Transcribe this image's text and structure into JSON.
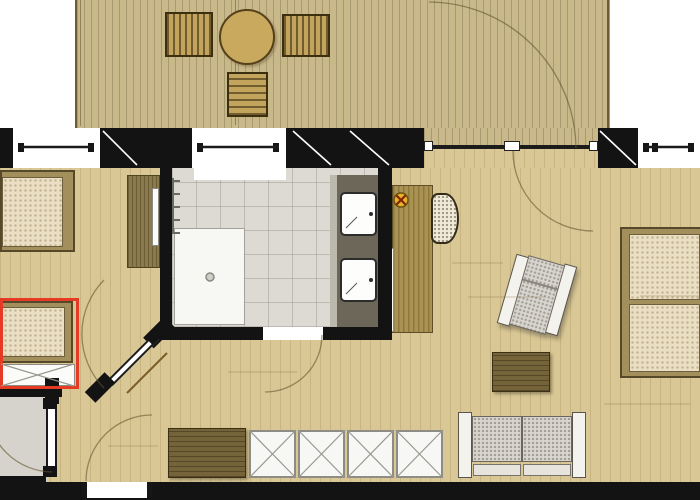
{
  "meta": {
    "title": "apartment-floor-plan",
    "description": "Top-view architectural floor plan of a suite: wooden terrace with loungers and round table at top, bedroom with two single beds (one highlighted red) at left, central bathroom with shower and double vanity, living/sleeping room at right with double bed, armchair, sofa, coffee table, desk and closet row",
    "canvas": {
      "width": 700,
      "height": 500
    },
    "visible_text": []
  },
  "palette": {
    "wall": "#131313",
    "deck_wood": "#c8b88a",
    "interior_wood": "#d9c895",
    "bath_tile": "#dcdad3",
    "vanity_counter": "#6d675a",
    "mattress": "#eadfc4",
    "dark_furniture_wood": "#75633a",
    "highlight_red": "#e63a24",
    "lamp_symbol_yellow": "#e9b22a",
    "upholstery_gray": "#d8d5ce"
  },
  "shapes": [
    {
      "name": "terrace-deck-floor",
      "cls": "deck",
      "x": 75,
      "y": 0,
      "w": 535,
      "h": 128
    },
    {
      "name": "deck-edge-line-left",
      "cls": "dline",
      "x": 80,
      "y": 0,
      "w": 1,
      "h": 126
    },
    {
      "name": "deck-edge-line-mid",
      "cls": "dline",
      "x": 235,
      "y": 0,
      "w": 1,
      "h": 125
    },
    {
      "name": "deck-edge-line-right",
      "cls": "dedge",
      "x": 607,
      "y": 0,
      "w": 2,
      "h": 128
    },
    {
      "name": "deck-lounger-1",
      "cls": "lounger",
      "x": 165,
      "y": 12,
      "w": 48,
      "h": 45
    },
    {
      "name": "deck-lounger-2",
      "cls": "lounger",
      "x": 282,
      "y": 14,
      "w": 48,
      "h": 43
    },
    {
      "name": "deck-round-table",
      "cls": "decktable",
      "x": 219,
      "y": 9,
      "w": 56,
      "h": 56
    },
    {
      "name": "deck-bench",
      "cls": "bench",
      "x": 227,
      "y": 72,
      "w": 41,
      "h": 45
    },
    {
      "name": "main-wood-floor",
      "cls": "floor",
      "x": 0,
      "y": 168,
      "w": 700,
      "h": 314
    },
    {
      "name": "vestibule-floor",
      "cls": "gray",
      "x": 0,
      "y": 395,
      "w": 47,
      "h": 87
    },
    {
      "name": "terrace-door-deck-strip",
      "cls": "decknb",
      "x": 424,
      "y": 128,
      "w": 174,
      "h": 19
    },
    {
      "name": "terrace-door-floor-strip",
      "cls": "floor",
      "x": 424,
      "y": 147,
      "w": 174,
      "h": 21
    },
    {
      "name": "bathroom-tile-floor",
      "cls": "tile",
      "x": 172,
      "y": 168,
      "w": 206,
      "h": 159
    },
    {
      "name": "window-2-sill-recess",
      "cls": "white",
      "x": 194,
      "y": 168,
      "w": 92,
      "h": 12
    },
    {
      "name": "shower-tray",
      "cls": "shower",
      "x": 174,
      "y": 228,
      "w": 71,
      "h": 97
    },
    {
      "name": "towel-radiator",
      "cls": "rad",
      "x": 172,
      "y": 178,
      "w": 8,
      "h": 56
    },
    {
      "name": "vanity-edge-strip",
      "cls": "ltstrip",
      "x": 330,
      "y": 175,
      "w": 7,
      "h": 155
    },
    {
      "name": "vanity-counter",
      "cls": "counter",
      "x": 337,
      "y": 175,
      "w": 41,
      "h": 155
    },
    {
      "name": "sink-1",
      "cls": "sink",
      "x": 340,
      "y": 192,
      "w": 37,
      "h": 44
    },
    {
      "name": "sink-2",
      "cls": "sink",
      "x": 340,
      "y": 258,
      "w": 37,
      "h": 44
    },
    {
      "name": "bed-1-frame",
      "cls": "bedframe",
      "x": 0,
      "y": 170,
      "w": 75,
      "h": 82
    },
    {
      "name": "bed-1-mattress",
      "cls": "matt",
      "x": 2,
      "y": 177,
      "w": 61,
      "h": 70
    },
    {
      "name": "bedroom-wardrobe",
      "cls": "dwv",
      "x": 127,
      "y": 175,
      "w": 33,
      "h": 93
    },
    {
      "name": "wardrobe-door-panel",
      "cls": "panel",
      "x": 152,
      "y": 188,
      "w": 7,
      "h": 58
    },
    {
      "name": "bed-2-frame",
      "cls": "bedframe",
      "x": 0,
      "y": 301,
      "w": 73,
      "h": 62
    },
    {
      "name": "bed-2-mattress",
      "cls": "matt",
      "x": 2,
      "y": 307,
      "w": 63,
      "h": 50
    },
    {
      "name": "bed-2-pullout-area",
      "cls": "panel",
      "x": 0,
      "y": 364,
      "w": 75,
      "h": 22
    },
    {
      "name": "desk",
      "cls": "desk",
      "x": 392,
      "y": 185,
      "w": 41,
      "h": 148
    },
    {
      "name": "desk-side-panel",
      "cls": "panel",
      "x": 387,
      "y": 248,
      "w": 7,
      "h": 84
    },
    {
      "name": "desk-chair",
      "cls": "wicker",
      "x": 431,
      "y": 193,
      "w": 28,
      "h": 51
    },
    {
      "name": "armchair",
      "cls": "shadowed",
      "x": 506,
      "y": 257,
      "w": 62,
      "h": 76,
      "rot": 16,
      "ch": [
        {
          "name": "armchair-arm-left",
          "cls": "armwhite",
          "x": 0,
          "y": 4,
          "w": 13,
          "h": 72
        },
        {
          "name": "armchair-arm-right",
          "cls": "armwhite",
          "x": 49,
          "y": 0,
          "w": 13,
          "h": 72
        },
        {
          "name": "armchair-cushion",
          "cls": "cushion",
          "x": 12,
          "y": 2,
          "w": 38,
          "h": 72
        },
        {
          "name": "armchair-seam",
          "cls": "seam",
          "x": 13,
          "y": 26,
          "w": 36,
          "h": 2
        }
      ]
    },
    {
      "name": "coffee-table",
      "cls": "dwh",
      "x": 492,
      "y": 352,
      "w": 58,
      "h": 40
    },
    {
      "name": "double-bed-frame",
      "cls": "bedframe",
      "x": 620,
      "y": 227,
      "w": 82,
      "h": 151
    },
    {
      "name": "double-bed-mattress-1",
      "cls": "matt",
      "x": 629,
      "y": 234,
      "w": 71,
      "h": 66
    },
    {
      "name": "double-bed-mattress-2",
      "cls": "matt",
      "x": 629,
      "y": 304,
      "w": 71,
      "h": 68
    },
    {
      "name": "sofa",
      "cls": "",
      "x": 458,
      "y": 410,
      "w": 128,
      "h": 68,
      "ch": [
        {
          "name": "sofa-arm-left",
          "cls": "armwhite",
          "x": 0,
          "y": 2,
          "w": 14,
          "h": 66
        },
        {
          "name": "sofa-arm-right",
          "cls": "armwhite",
          "x": 114,
          "y": 2,
          "w": 14,
          "h": 66
        },
        {
          "name": "sofa-cushion-1",
          "cls": "cushion",
          "x": 14,
          "y": 6,
          "w": 50,
          "h": 46
        },
        {
          "name": "sofa-cushion-2",
          "cls": "cushion",
          "x": 64,
          "y": 6,
          "w": 50,
          "h": 46
        },
        {
          "name": "sofa-back-1",
          "cls": "strip2",
          "x": 15,
          "y": 54,
          "w": 48,
          "h": 12
        },
        {
          "name": "sofa-back-2",
          "cls": "strip2",
          "x": 65,
          "y": 54,
          "w": 48,
          "h": 12
        }
      ]
    },
    {
      "name": "closet-cabinet-dark",
      "cls": "dwh",
      "x": 168,
      "y": 428,
      "w": 78,
      "h": 50
    },
    {
      "name": "closet-unit-1",
      "cls": "xunit",
      "x": 249,
      "y": 430,
      "w": 47,
      "h": 48
    },
    {
      "name": "closet-unit-2",
      "cls": "xunit",
      "x": 298,
      "y": 430,
      "w": 47,
      "h": 48
    },
    {
      "name": "closet-unit-3",
      "cls": "xunit",
      "x": 347,
      "y": 430,
      "w": 47,
      "h": 48
    },
    {
      "name": "closet-unit-4",
      "cls": "xunit",
      "x": 396,
      "y": 430,
      "w": 47,
      "h": 48
    },
    {
      "name": "wall-top-left-corner",
      "cls": "wall",
      "x": 0,
      "y": 128,
      "w": 13,
      "h": 40
    },
    {
      "name": "window-1",
      "cls": "white",
      "x": 13,
      "y": 128,
      "w": 87,
      "h": 40
    },
    {
      "name": "wall-pier-a",
      "cls": "wall",
      "x": 100,
      "y": 128,
      "w": 92,
      "h": 40
    },
    {
      "name": "window-2",
      "cls": "white",
      "x": 192,
      "y": 128,
      "w": 94,
      "h": 40
    },
    {
      "name": "wall-pier-b",
      "cls": "wall",
      "x": 286,
      "y": 128,
      "w": 138,
      "h": 40
    },
    {
      "name": "terrace-door-track",
      "cls": "track",
      "x": 431,
      "y": 145,
      "w": 162,
      "h": 4
    },
    {
      "name": "terrace-door-frame-mark-1",
      "cls": "wcap",
      "x": 424,
      "y": 141,
      "w": 9,
      "h": 10
    },
    {
      "name": "terrace-door-frame-mark-2",
      "cls": "wcap",
      "x": 504,
      "y": 141,
      "w": 16,
      "h": 10
    },
    {
      "name": "terrace-door-frame-mark-3",
      "cls": "wcap",
      "x": 589,
      "y": 141,
      "w": 9,
      "h": 10
    },
    {
      "name": "wall-pier-c",
      "cls": "wall",
      "x": 598,
      "y": 128,
      "w": 40,
      "h": 40
    },
    {
      "name": "window-3",
      "cls": "white",
      "x": 638,
      "y": 128,
      "w": 62,
      "h": 40
    },
    {
      "name": "window-1-cap-left",
      "cls": "cap",
      "x": 18,
      "y": 143,
      "w": 6,
      "h": 9
    },
    {
      "name": "window-1-cap-right",
      "cls": "cap",
      "x": 88,
      "y": 143,
      "w": 6,
      "h": 9
    },
    {
      "name": "window-2-cap-left",
      "cls": "cap",
      "x": 197,
      "y": 143,
      "w": 6,
      "h": 9
    },
    {
      "name": "window-2-cap-right",
      "cls": "cap",
      "x": 273,
      "y": 143,
      "w": 6,
      "h": 9
    },
    {
      "name": "window-3-cap-left",
      "cls": "cap",
      "x": 643,
      "y": 143,
      "w": 6,
      "h": 9
    },
    {
      "name": "window-3-cap-mid",
      "cls": "cap",
      "x": 652,
      "y": 143,
      "w": 6,
      "h": 9
    },
    {
      "name": "window-3-cap-right",
      "cls": "cap",
      "x": 688,
      "y": 143,
      "w": 6,
      "h": 9
    },
    {
      "name": "wall-bathroom-left",
      "cls": "wall",
      "x": 160,
      "y": 168,
      "w": 12,
      "h": 172
    },
    {
      "name": "wall-bathroom-right",
      "cls": "wall",
      "x": 378,
      "y": 168,
      "w": 14,
      "h": 172
    },
    {
      "name": "wall-bathroom-bottom-left",
      "cls": "wall",
      "x": 160,
      "y": 327,
      "w": 103,
      "h": 13
    },
    {
      "name": "bathroom-door-threshold",
      "cls": "white",
      "x": 263,
      "y": 327,
      "w": 60,
      "h": 13
    },
    {
      "name": "wall-bathroom-bottom-right",
      "cls": "wall",
      "x": 323,
      "y": 327,
      "w": 69,
      "h": 13
    },
    {
      "name": "wall-bedroom-bottom",
      "cls": "wall",
      "x": 0,
      "y": 388,
      "w": 62,
      "h": 9
    },
    {
      "name": "wall-vestibule-stub",
      "cls": "wall",
      "x": 45,
      "y": 378,
      "w": 14,
      "h": 26
    },
    {
      "name": "wall-bottom-left-corner",
      "cls": "wall",
      "x": 0,
      "y": 476,
      "w": 46,
      "h": 8
    },
    {
      "name": "wall-bottom",
      "cls": "wall",
      "x": 0,
      "y": 482,
      "w": 700,
      "h": 18
    },
    {
      "name": "entry-door-threshold",
      "cls": "white",
      "x": 86,
      "y": 482,
      "w": 62,
      "h": 16
    },
    {
      "name": "entry-jamb-left",
      "cls": "cap",
      "x": 82,
      "y": 482,
      "w": 5,
      "h": 16
    },
    {
      "name": "entry-jamb-right",
      "cls": "cap",
      "x": 147,
      "y": 482,
      "w": 5,
      "h": 16
    },
    {
      "name": "bedroom-door-stub-lower",
      "cls": "wall",
      "x": 86,
      "y": 380,
      "w": 28,
      "h": 15,
      "rot": -45
    },
    {
      "name": "bedroom-door-stub-upper",
      "cls": "wall",
      "x": 144,
      "y": 325,
      "w": 30,
      "h": 15,
      "rot": -45
    },
    {
      "name": "bedroom-door-leaf",
      "cls": "doorleaf",
      "x": 100,
      "y": 356,
      "w": 66,
      "h": 8,
      "rot": -45
    },
    {
      "name": "bedroom-door-hinge-1",
      "cls": "wall",
      "x": 104,
      "y": 378,
      "w": 9,
      "h": 9,
      "rot": -45
    },
    {
      "name": "bedroom-door-hinge-2",
      "cls": "wall",
      "x": 148,
      "y": 334,
      "w": 9,
      "h": 9,
      "rot": -45
    },
    {
      "name": "vestibule-door-leaf",
      "cls": "doorleaf",
      "x": 46,
      "y": 406,
      "w": 11,
      "h": 66
    },
    {
      "name": "vestibule-door-hinge-1",
      "cls": "wall",
      "x": 43,
      "y": 398,
      "w": 14,
      "h": 11
    },
    {
      "name": "vestibule-door-hinge-2",
      "cls": "wall",
      "x": 43,
      "y": 466,
      "w": 14,
      "h": 11
    },
    {
      "name": "bed-2-highlight-box",
      "cls": "redbox",
      "x": 0,
      "y": 298,
      "w": 79,
      "h": 91
    }
  ],
  "svg": [
    {
      "kind": "path",
      "name": "terrace-door-swing-arc-outer",
      "cls": "arc",
      "d": "M 576 148 A 148 148 0 0 0 429 2"
    },
    {
      "kind": "path",
      "name": "terrace-door-swing-arc-inner",
      "cls": "arc",
      "d": "M 513 151 A 80 80 0 0 0 593 231"
    },
    {
      "kind": "path",
      "name": "bedroom-door-swing-arc",
      "cls": "arc",
      "d": "M 104 388 A 77 77 0 0 1 104 280"
    },
    {
      "kind": "path",
      "name": "vestibule-door-swing-arc",
      "cls": "arc",
      "d": "M 52 472 A 66 66 0 0 1 -13 406"
    },
    {
      "kind": "path",
      "name": "entry-door-swing-arc",
      "cls": "arc",
      "d": "M 86 481 A 66 66 0 0 1 152 415"
    },
    {
      "kind": "path",
      "name": "bathroom-door-swing-arc",
      "cls": "arc",
      "d": "M 322 335 A 57 57 0 0 1 265 392"
    },
    {
      "kind": "line",
      "name": "window-1-glazing",
      "cls": "glz",
      "x1": 20,
      "y1": 147,
      "x2": 93,
      "y2": 147
    },
    {
      "kind": "line",
      "name": "window-2-glazing",
      "cls": "glz",
      "x1": 199,
      "y1": 147,
      "x2": 279,
      "y2": 147
    },
    {
      "kind": "line",
      "name": "window-3-glazing",
      "cls": "glz",
      "x1": 645,
      "y1": 147,
      "x2": 694,
      "y2": 147
    },
    {
      "kind": "line",
      "name": "pier-a-hatch",
      "cls": "wdiag",
      "x1": 103,
      "y1": 131,
      "x2": 137,
      "y2": 165
    },
    {
      "kind": "line",
      "name": "pier-b-hatch-1",
      "cls": "wdiag",
      "x1": 293,
      "y1": 131,
      "x2": 331,
      "y2": 165
    },
    {
      "kind": "line",
      "name": "pier-b-hatch-2",
      "cls": "wdiag",
      "x1": 350,
      "y1": 131,
      "x2": 389,
      "y2": 165
    },
    {
      "kind": "line",
      "name": "pier-c-hatch",
      "cls": "wdiag",
      "x1": 600,
      "y1": 131,
      "x2": 636,
      "y2": 165
    },
    {
      "kind": "line",
      "name": "closet-unit-1-x-a",
      "cls": "xl",
      "x1": 249,
      "y1": 430,
      "x2": 296,
      "y2": 478
    },
    {
      "kind": "line",
      "name": "closet-unit-1-x-b",
      "cls": "xl",
      "x1": 249,
      "y1": 478,
      "x2": 296,
      "y2": 430
    },
    {
      "kind": "line",
      "name": "closet-unit-2-x-a",
      "cls": "xl",
      "x1": 298,
      "y1": 430,
      "x2": 345,
      "y2": 478
    },
    {
      "kind": "line",
      "name": "closet-unit-2-x-b",
      "cls": "xl",
      "x1": 298,
      "y1": 478,
      "x2": 345,
      "y2": 430
    },
    {
      "kind": "line",
      "name": "closet-unit-3-x-a",
      "cls": "xl",
      "x1": 347,
      "y1": 430,
      "x2": 394,
      "y2": 478
    },
    {
      "kind": "line",
      "name": "closet-unit-3-x-b",
      "cls": "xl",
      "x1": 347,
      "y1": 478,
      "x2": 394,
      "y2": 430
    },
    {
      "kind": "line",
      "name": "closet-unit-4-x-a",
      "cls": "xl",
      "x1": 396,
      "y1": 430,
      "x2": 443,
      "y2": 478
    },
    {
      "kind": "line",
      "name": "closet-unit-4-x-b",
      "cls": "xl",
      "x1": 396,
      "y1": 478,
      "x2": 443,
      "y2": 430
    },
    {
      "kind": "line",
      "name": "pullout-x-a",
      "cls": "xl",
      "x1": 1,
      "y1": 364,
      "x2": 74,
      "y2": 386
    },
    {
      "kind": "line",
      "name": "pullout-x-b",
      "cls": "xl",
      "x1": 1,
      "y1": 386,
      "x2": 74,
      "y2": 364
    },
    {
      "kind": "circle",
      "name": "lamp-symbol-circle",
      "cls": "lampc",
      "cx": 401,
      "cy": 200,
      "r": 7
    },
    {
      "kind": "line",
      "name": "lamp-symbol-x-a",
      "cls": "lampx",
      "x1": 397,
      "y1": 196,
      "x2": 405,
      "y2": 204
    },
    {
      "kind": "line",
      "name": "lamp-symbol-x-b",
      "cls": "lampx",
      "x1": 405,
      "y1": 196,
      "x2": 397,
      "y2": 204
    },
    {
      "kind": "circle",
      "name": "shower-drain",
      "cls": "drain",
      "cx": 210,
      "cy": 277,
      "r": 4
    },
    {
      "kind": "circle",
      "name": "sink-1-faucet-dot",
      "cls": "dot",
      "cx": 371,
      "cy": 214,
      "r": 2
    },
    {
      "kind": "circle",
      "name": "sink-2-faucet-dot",
      "cls": "dot",
      "cx": 371,
      "cy": 280,
      "r": 2
    },
    {
      "kind": "line",
      "name": "sink-1-crease",
      "cls": "sinkline",
      "x1": 346,
      "y1": 228,
      "x2": 357,
      "y2": 217
    },
    {
      "kind": "line",
      "name": "sink-2-crease",
      "cls": "sinkline",
      "x1": 346,
      "y1": 294,
      "x2": 357,
      "y2": 283
    },
    {
      "kind": "line",
      "name": "bedroom-door-floor-line",
      "cls": "browndiag",
      "x1": 127,
      "y1": 393,
      "x2": 167,
      "y2": 353
    },
    {
      "kind": "line",
      "name": "floor-joint-1",
      "cls": "joint",
      "x1": 468,
      "y1": 297,
      "x2": 545,
      "y2": 297
    },
    {
      "kind": "line",
      "name": "floor-joint-2",
      "cls": "joint",
      "x1": 452,
      "y1": 263,
      "x2": 503,
      "y2": 263
    },
    {
      "kind": "line",
      "name": "floor-joint-3",
      "cls": "joint",
      "x1": 228,
      "y1": 372,
      "x2": 297,
      "y2": 372
    },
    {
      "kind": "line",
      "name": "floor-joint-4",
      "cls": "joint",
      "x1": 604,
      "y1": 404,
      "x2": 690,
      "y2": 404
    },
    {
      "kind": "line",
      "name": "floor-joint-5",
      "cls": "joint",
      "x1": 108,
      "y1": 446,
      "x2": 158,
      "y2": 446
    },
    {
      "kind": "line",
      "name": "floor-joint-6",
      "cls": "joint",
      "x1": 640,
      "y1": 296,
      "x2": 700,
      "y2": 296
    }
  ]
}
